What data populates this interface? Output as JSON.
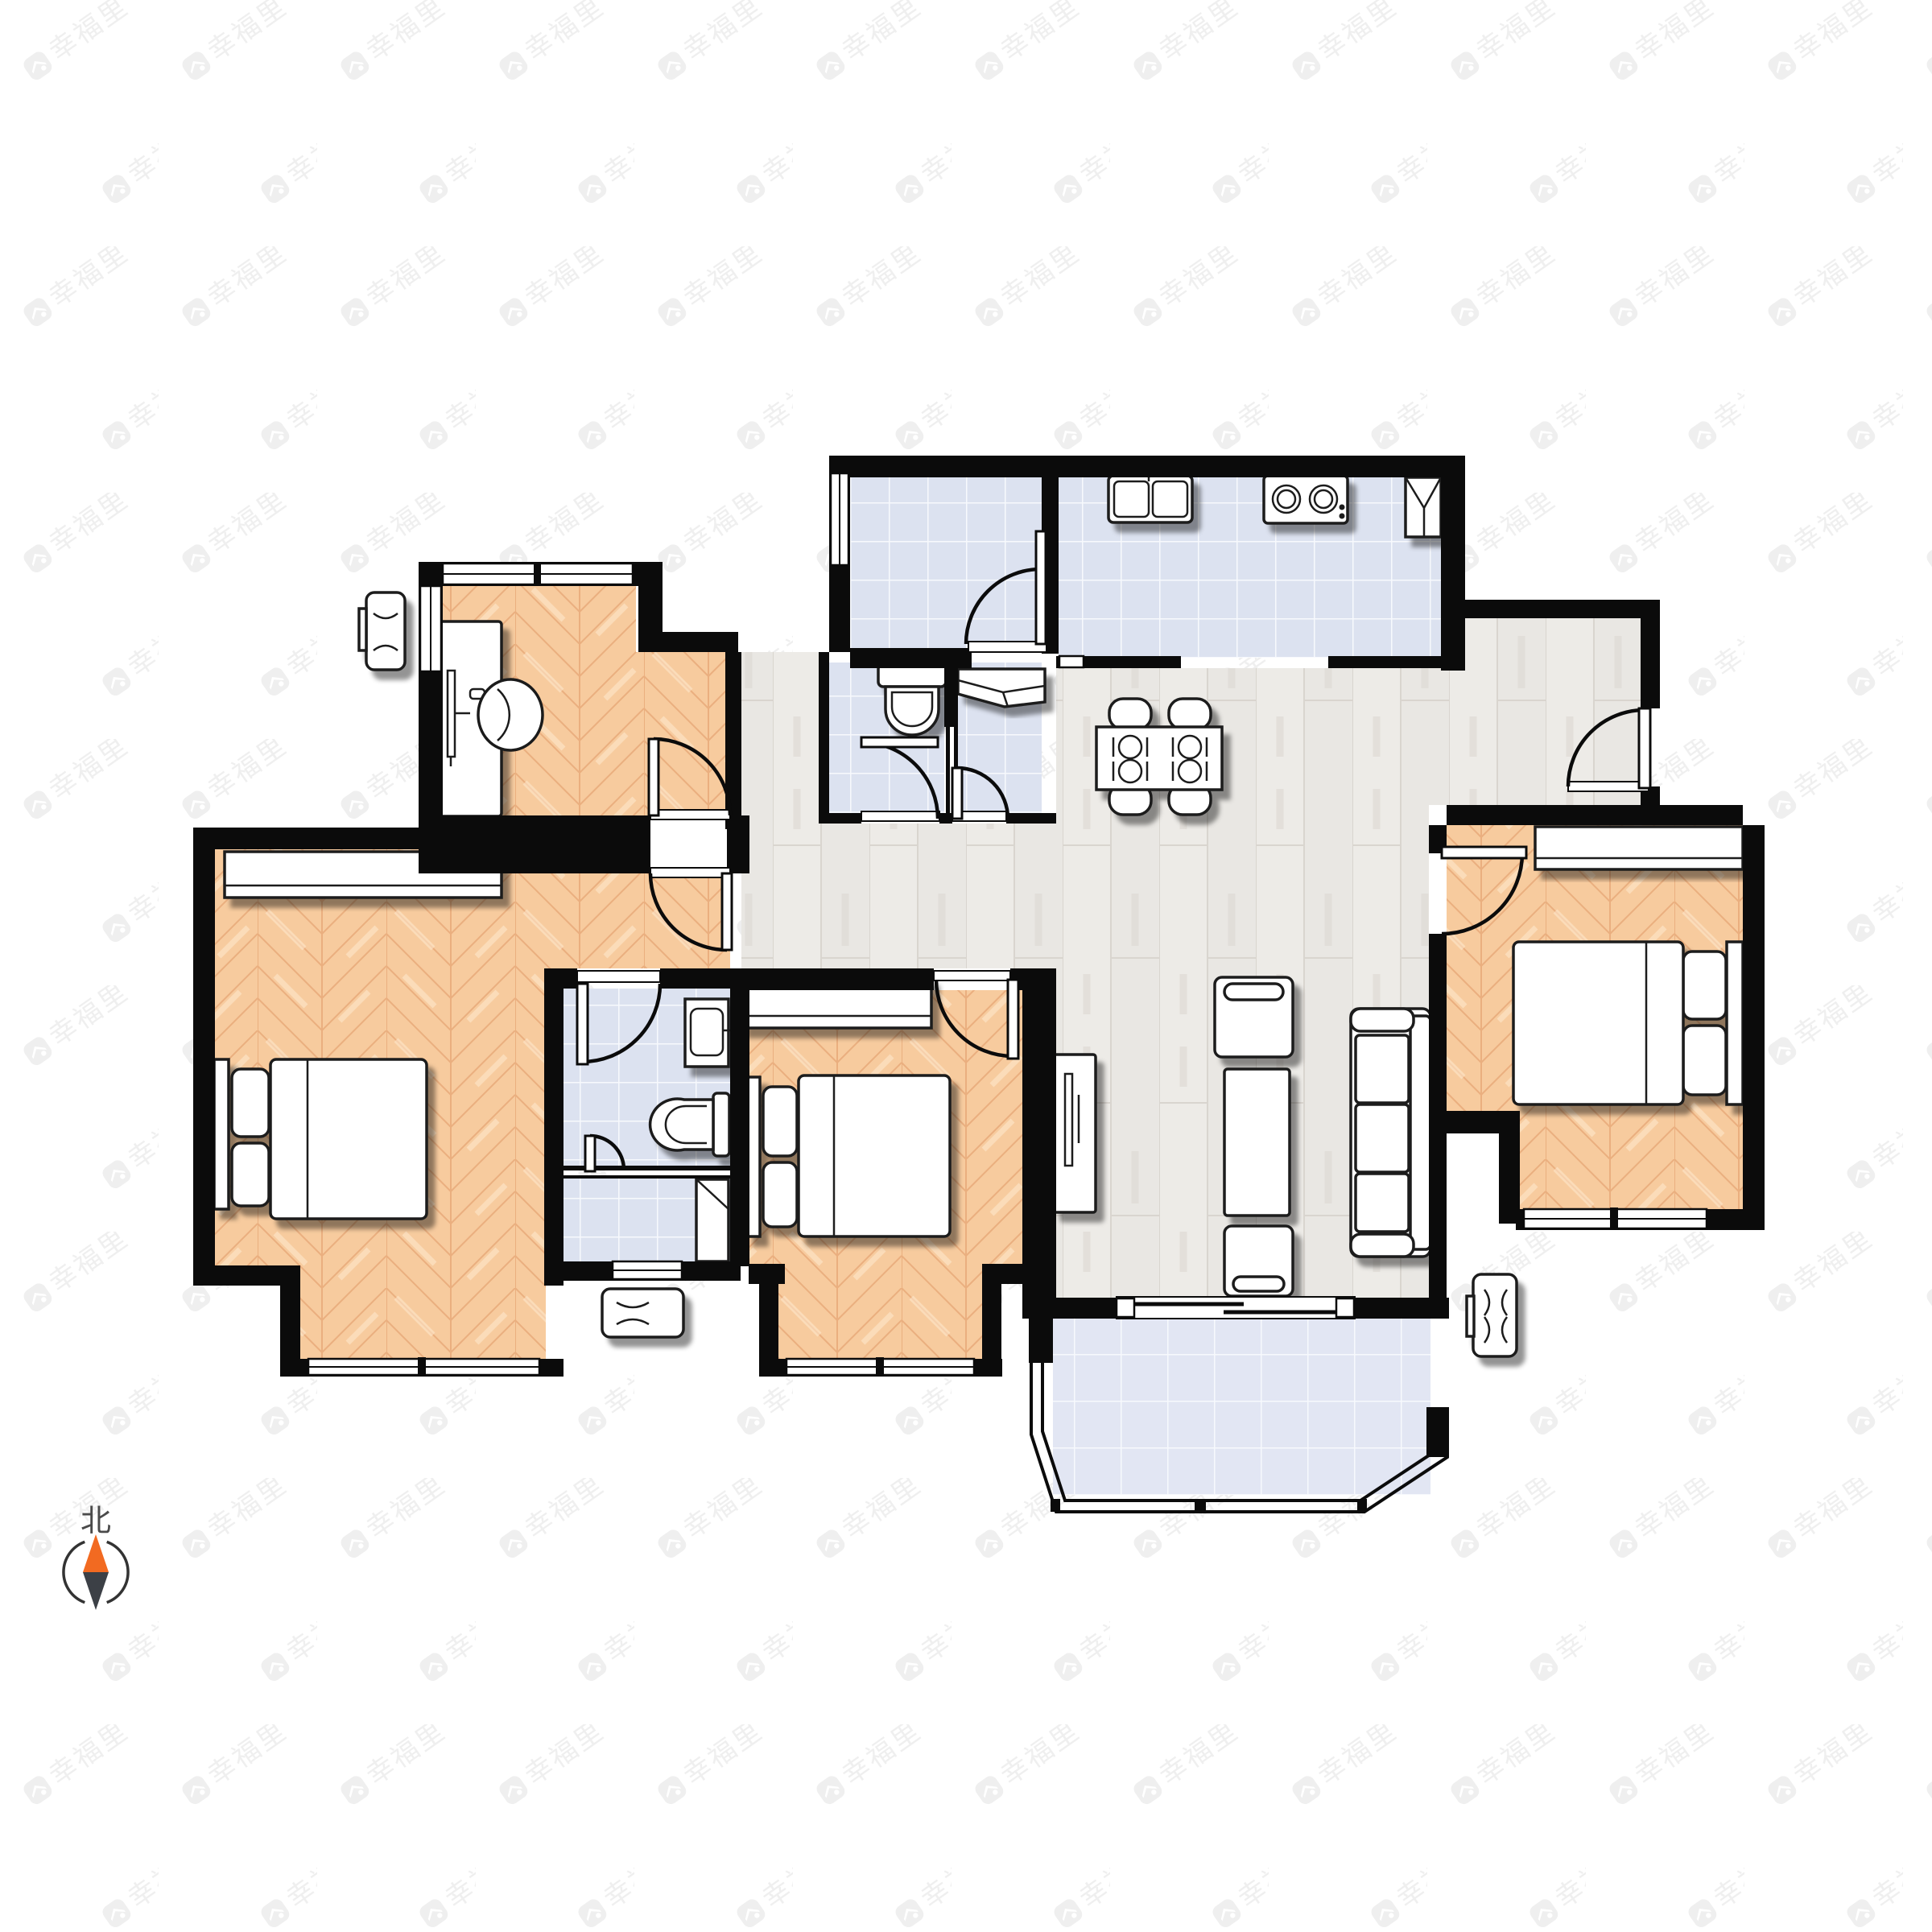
{
  "meta": {
    "type": "residential-floorplan",
    "units_shown": "none",
    "background_color": "#ffffff"
  },
  "watermark": {
    "text": "幸福里",
    "logo": "house-badge-icon",
    "color": "#efefef",
    "rotation_deg": -35
  },
  "compass": {
    "north_label": "北",
    "needle_north_color": "#f26a21",
    "needle_south_color": "#3c4046",
    "ring_color": "#333333",
    "label_color": "#4a4a4a"
  },
  "palette": {
    "wall": "#0b0b0b",
    "bedroom_wood": "#f7cb9e",
    "bedroom_wood_grain": "#eaaf7f",
    "living_wood": "#e9e7e3",
    "living_wood_grain": "#d9d5cf",
    "tile": "#dce2f0",
    "tile_grout": "#f7f9fd",
    "balcony_tile": "#e2e6f3",
    "furniture_fill": "#ffffff",
    "furniture_stroke": "#1b1b1b",
    "shadow": "rgba(0,0,0,0.45)"
  },
  "rooms": [
    {
      "id": "study",
      "floor": "bedroom_wood",
      "furniture": [
        "desk",
        "desk-chair",
        "ac-outdoor-unit"
      ]
    },
    {
      "id": "bedroom-left",
      "floor": "bedroom_wood",
      "furniture": [
        "double-bed",
        "wardrobe"
      ]
    },
    {
      "id": "bedroom-middle",
      "floor": "bedroom_wood",
      "furniture": [
        "double-bed",
        "wardrobe"
      ]
    },
    {
      "id": "bedroom-right",
      "floor": "bedroom_wood",
      "furniture": [
        "double-bed",
        "wardrobe"
      ]
    },
    {
      "id": "living-dining",
      "floor": "living_wood",
      "furniture": [
        "dining-table-4-chairs",
        "sofa",
        "armchair",
        "coffee-table",
        "ottoman",
        "tv-console"
      ]
    },
    {
      "id": "kitchen",
      "floor": "tile",
      "furniture": [
        "double-sink",
        "cooktop",
        "corner-cabinet"
      ]
    },
    {
      "id": "utility-room",
      "floor": "tile",
      "furniture": []
    },
    {
      "id": "toilet-room",
      "floor": "tile",
      "furniture": [
        "toilet"
      ]
    },
    {
      "id": "wash-room",
      "floor": "tile",
      "furniture": [
        "counter"
      ]
    },
    {
      "id": "bathroom",
      "floor": "tile",
      "furniture": [
        "washbasin",
        "toilet",
        "washing-machine"
      ]
    },
    {
      "id": "balcony",
      "floor": "balcony_tile",
      "furniture": [
        "ac-outdoor-unit"
      ]
    },
    {
      "id": "hallway",
      "floor": "living_wood",
      "furniture": []
    }
  ]
}
